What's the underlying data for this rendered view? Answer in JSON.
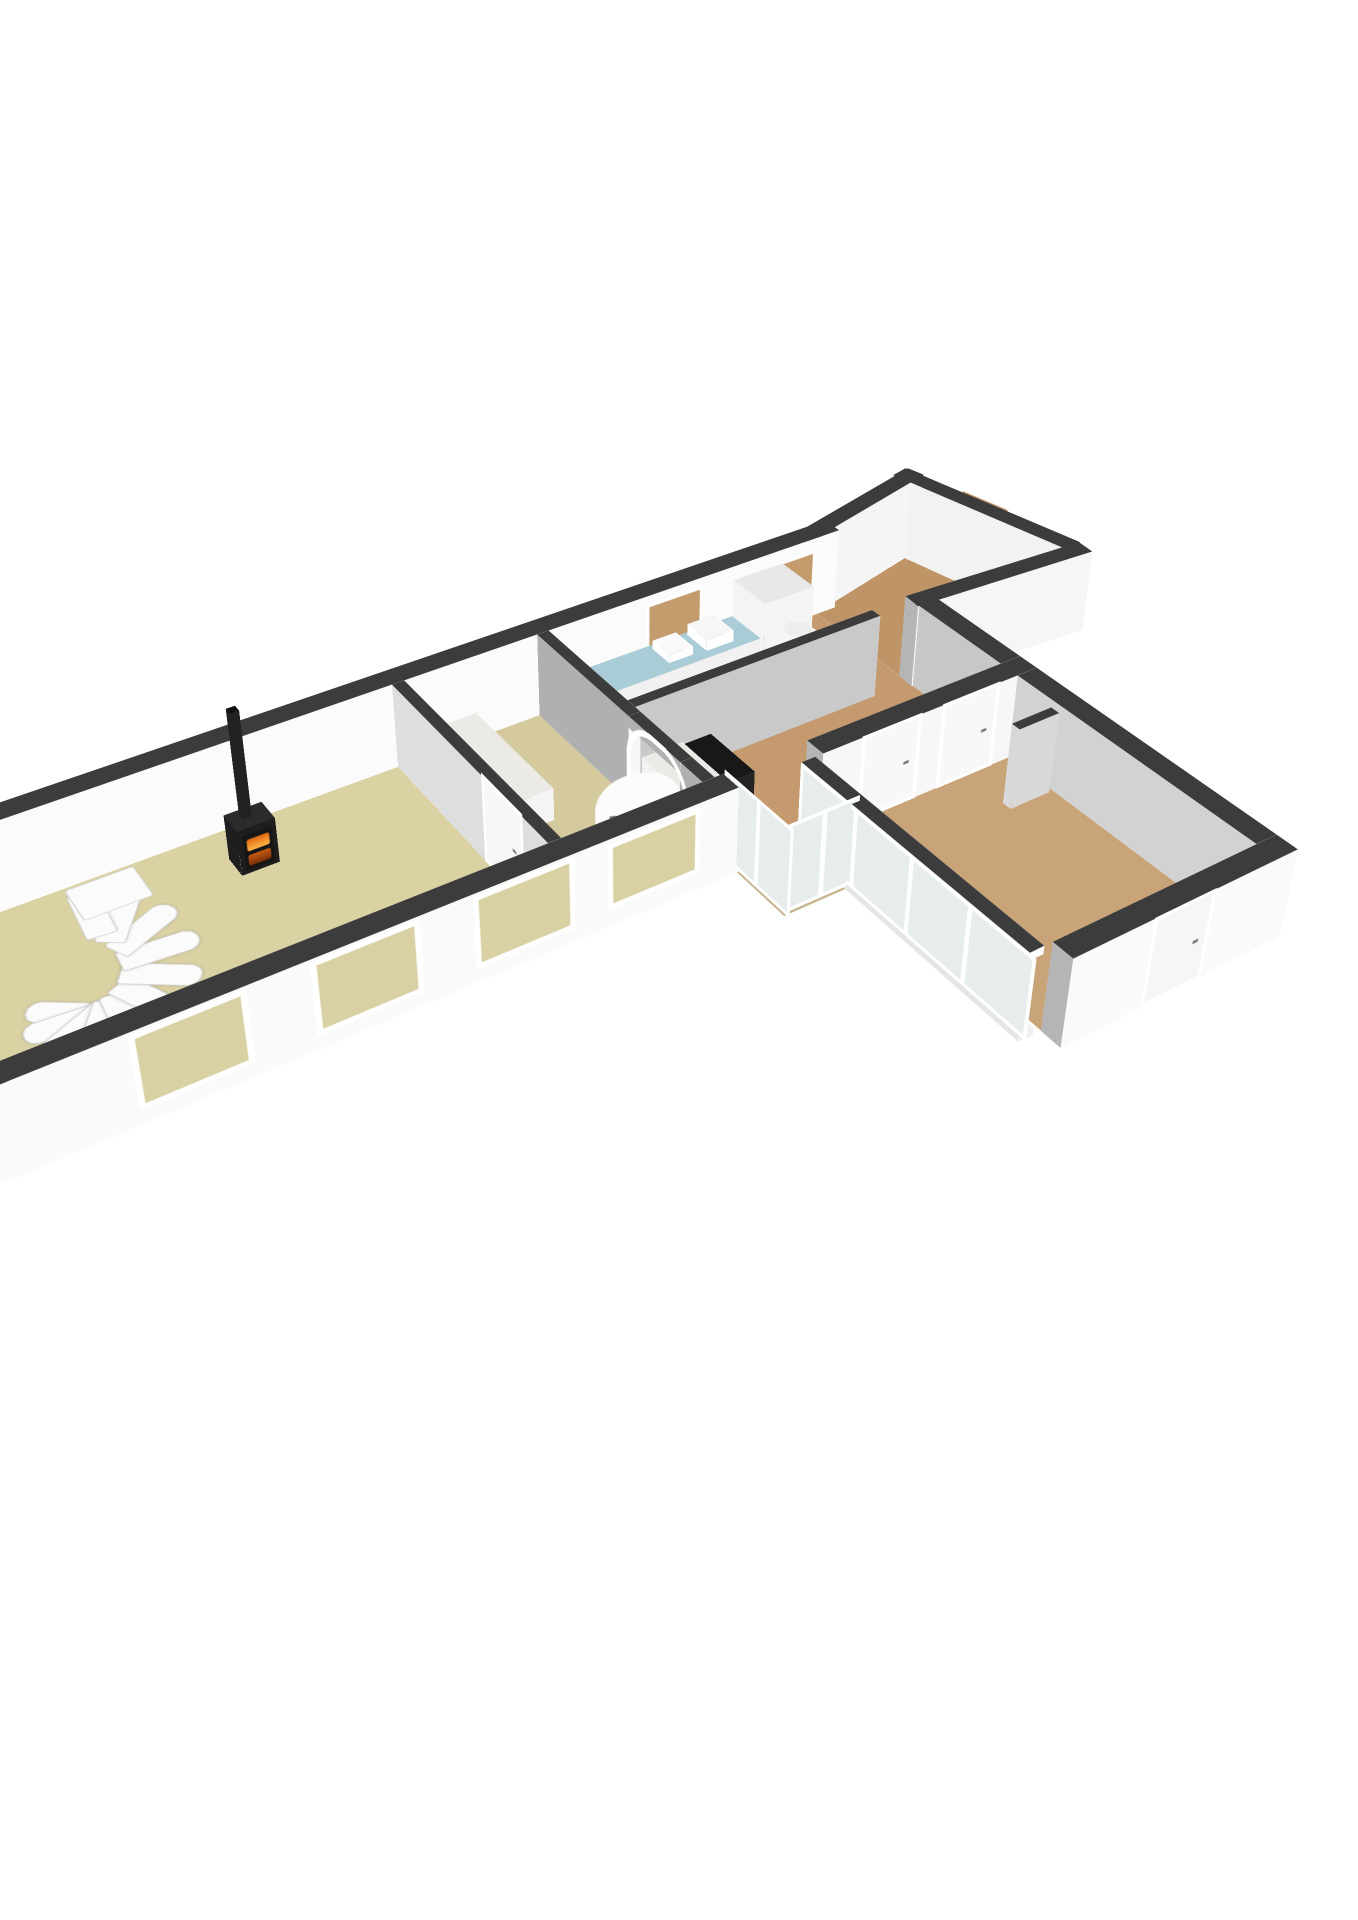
{
  "meta": {
    "view_label": "3d-floorplan-ground-floor",
    "background": "#ffffff"
  },
  "palette": {
    "cap": "#3c3c3c",
    "wallWhite": "#f8f8f8",
    "wallLight": "#eeeeee",
    "wallGray": "#b5b5b5",
    "wallE": "#e9e9e9",
    "floorLiving": "#dbd2a4",
    "floorBath": "#d5c99e",
    "floorWood": "#c49a6e",
    "floorPorch": "#bf9466",
    "floorWing": "#c9a478",
    "floorWC": "#c6b68e",
    "counterBlue": "#a9ccd6",
    "marble": "#eceae6",
    "stoveBlack": "#1e1e1e",
    "fireBright": "#ffb547",
    "fireDeep": "#e06810",
    "glass": "#e7ecec",
    "frameWhite": "#ffffff",
    "doorBrown": "#b58a58",
    "windowBeige": "#d9d0a3",
    "windowTan": "#c39b6d",
    "stairWhite": "#fbfbfb"
  },
  "scene": {
    "wallHeight": 88,
    "camera": {
      "perspective": 1800,
      "perspectiveOrigin": "47% 33%",
      "left": "48%",
      "top": "46%",
      "transform": "scale(1.22) rotateX(57deg) rotateZ(-33deg) translate3d(-540px,-255px,0px)"
    },
    "wallDefaults": {
      "top": "cap",
      "n": "wallLight",
      "s": "wallWhite",
      "e": "wallE",
      "w": "wallGray"
    },
    "floors": [
      {
        "name": "floor-living-room",
        "x": 0,
        "y": 0,
        "w": 440,
        "d": 260,
        "color": "floorLiving"
      },
      {
        "name": "floor-bathroom",
        "x": 452,
        "y": 0,
        "w": 133,
        "d": 260,
        "color": "floorBath"
      },
      {
        "name": "floor-hall-kitchen",
        "x": 597,
        "y": 0,
        "w": 303,
        "d": 260,
        "color": "floorWood"
      },
      {
        "name": "floor-passage",
        "x": 668,
        "y": 260,
        "w": 22,
        "d": 24,
        "color": "floorWood"
      },
      {
        "name": "floor-wc",
        "x": 606,
        "y": 260,
        "w": 62,
        "d": 88,
        "color": "floorWC"
      },
      {
        "name": "floor-wing-room",
        "x": 690,
        "y": 282,
        "w": 210,
        "d": 278,
        "color": "floorWing"
      },
      {
        "name": "floor-porch",
        "x": 900,
        "y": -44,
        "w": 193,
        "d": 190,
        "color": "floorPorch",
        "clip": "polygon(0% 19%, 78% 0%, 100% 97%, 0% 100%)"
      }
    ],
    "walls": [
      {
        "name": "wall-back-exterior",
        "x": -22,
        "y": -22,
        "w": 944,
        "d": 22,
        "colors": {
          "s": "#fbfbfb",
          "n": "#e4e4e4",
          "w": "#dadada",
          "e": "#e2e2e2"
        }
      },
      {
        "name": "wall-left-end",
        "x": -22,
        "y": 0,
        "w": 22,
        "d": 282,
        "colors": {
          "e": "#f3f3f3",
          "w": "#d8d8d8",
          "s": "#efefef",
          "n": "#ececec"
        }
      },
      {
        "name": "wall-front-main",
        "x": -22,
        "y": 260,
        "w": 630,
        "d": 22,
        "colors": {
          "s": "#fafafa",
          "n": "#ebebeb"
        }
      },
      {
        "name": "wall-main-end",
        "x": 900,
        "y": 142,
        "w": 22,
        "d": 118,
        "colors": {
          "w": "#c7c7c7"
        }
      },
      {
        "name": "wall-wing-nw",
        "x": 690,
        "y": 260,
        "w": 232,
        "d": 22,
        "colors": {
          "s": "#f7f7f7",
          "n": "#ebebeb"
        }
      },
      {
        "name": "wall-wing-ne",
        "x": 900,
        "y": 282,
        "w": 22,
        "d": 278,
        "colors": {
          "w": "#d2d2d2",
          "e": "#e8e8e8"
        }
      },
      {
        "name": "wall-wing-se",
        "x": 690,
        "y": 560,
        "w": 232,
        "d": 22,
        "colors": {
          "n": "#f1f1f1",
          "s": "#fafafa"
        }
      },
      {
        "name": "wall-living-divider",
        "x": 440,
        "y": 0,
        "w": 12,
        "d": 260,
        "colors": {
          "w": "#dedede",
          "e": "#f0f0f0"
        }
      },
      {
        "name": "wall-arch-upper",
        "x": 585,
        "y": 0,
        "w": 12,
        "d": 150,
        "colors": {
          "w": "#b0b0b0",
          "e": "#c9c9c9"
        }
      },
      {
        "name": "wall-arch-lower",
        "x": 585,
        "y": 228,
        "w": 12,
        "d": 32,
        "colors": {
          "w": "#b0b0b0",
          "e": "#c9c9c9"
        }
      },
      {
        "name": "wall-arch-lintel",
        "x": 585,
        "y": 150,
        "w": 12,
        "d": 78,
        "z0": 76,
        "h": 12,
        "colors": {
          "w": "#b0b0b0",
          "e": "#c9c9c9"
        }
      },
      {
        "name": "wall-kitchen-mid",
        "x": 597,
        "y": 130,
        "w": 263,
        "d": 12,
        "colors": {
          "s": "#c9c9c9",
          "n": "#d9d9d9"
        }
      },
      {
        "name": "wall-porch-angled",
        "x": 900,
        "y": -22,
        "rot": -14,
        "w": 160,
        "d": 20,
        "colors": {
          "s": "#f5f5f5",
          "n": "#e6e6e6"
        }
      },
      {
        "name": "wall-porch-ne",
        "x": 1053,
        "y": -62,
        "rot": 77,
        "w": 210,
        "d": 20,
        "colors": {
          "n": "#bdbdbd",
          "s": "#f2f2f2"
        }
      },
      {
        "name": "wall-porch-south",
        "x": 900,
        "y": 128,
        "rot": 4,
        "w": 200,
        "d": 20,
        "colors": {
          "n": "#e9e9e9",
          "s": "#f6f6f6"
        }
      },
      {
        "name": "wall-wing-glass-sill",
        "x": 668,
        "y": 282,
        "w": 14,
        "d": 278,
        "h": 7,
        "colors": {
          "top": "#f2f2f2",
          "s": "#efefef",
          "n": "#efefef",
          "e": "#efefef",
          "w": "#e5e5e5"
        }
      },
      {
        "name": "wall-wing-glass-rail",
        "x": 668,
        "y": 282,
        "w": 14,
        "d": 278,
        "z0": 80,
        "h": 8,
        "colors": {
          "s": "#fdfdfd",
          "n": "#fdfdfd",
          "e": "#f4f4f4",
          "w": "#f4f4f4"
        }
      }
    ],
    "boxes": [
      {
        "name": "wood-stove",
        "x": 262,
        "y": 38,
        "w": 34,
        "d": 26,
        "h": 46,
        "top": "#2b2b2b",
        "side": "stoveBlack"
      },
      {
        "name": "stove-chimney",
        "x": 273,
        "y": 44,
        "w": 8,
        "d": 8,
        "z0": 46,
        "h": 106,
        "top": "#111111",
        "side": "#222222"
      },
      {
        "name": "bathtub",
        "x": 456,
        "y": 8,
        "w": 60,
        "d": 132,
        "h": 34,
        "top": "marble",
        "side": "#f4f4f4"
      },
      {
        "name": "shower-tray",
        "x": 460,
        "y": 196,
        "w": 86,
        "d": 56,
        "h": 7,
        "top": "#f4f4f4",
        "side": "#e8e8e8"
      },
      {
        "name": "hall-counter",
        "x": 601,
        "y": 146,
        "w": 42,
        "d": 66,
        "h": 36,
        "top": "marble",
        "side": "#f2f2f2"
      },
      {
        "name": "hall-black-counter",
        "x": 643,
        "y": 146,
        "w": 30,
        "d": 66,
        "h": 33,
        "top": "#181818",
        "side": "#242424"
      },
      {
        "name": "kitchen-counter",
        "x": 612,
        "y": 6,
        "w": 182,
        "d": 46,
        "h": 38,
        "top": "counterBlue",
        "side": "#f1f1f1"
      },
      {
        "name": "kitchen-sink",
        "x": 700,
        "y": 12,
        "w": 26,
        "d": 28,
        "z0": 38,
        "h": 9,
        "top": "#fafafa",
        "side": "#ffffff"
      },
      {
        "name": "kitchen-appliance",
        "x": 740,
        "y": 10,
        "w": 30,
        "d": 32,
        "z0": 38,
        "h": 12,
        "top": "#f6f6f6",
        "side": "#ffffff"
      },
      {
        "name": "fridge-cabinet",
        "x": 796,
        "y": 4,
        "w": 56,
        "d": 50,
        "h": 76,
        "top": "#e8e8e8",
        "side": "#f4f4f4"
      },
      {
        "name": "boiler-cylinder",
        "x": 806,
        "y": 62,
        "w": 26,
        "d": 26,
        "h": 52,
        "round": true,
        "top": "#ededed",
        "side": "#f6f6f6"
      },
      {
        "name": "toilet-bowl",
        "x": 622,
        "y": 300,
        "w": 22,
        "d": 22,
        "h": 24,
        "round": true,
        "top": "#f6f6f6",
        "side": "#fdfdfd"
      },
      {
        "name": "toilet-cistern",
        "x": 642,
        "y": 296,
        "w": 14,
        "d": 26,
        "h": 36,
        "top": "#f2f2f2",
        "side": "#fcfcfc"
      },
      {
        "name": "utility-unit",
        "x": 608,
        "y": 264,
        "w": 26,
        "d": 18,
        "h": 42,
        "top": "#555555",
        "side": "#4a4a4a"
      },
      {
        "name": "wing-closet-door",
        "x": 852,
        "y": 330,
        "w": 44,
        "d": 10,
        "h": 84,
        "top": "#3c3c3c",
        "side": "#d8d8d8"
      }
    ],
    "decals": [
      {
        "name": "window-left-end",
        "axis": "u",
        "x": -22.6,
        "y": 60,
        "z": 14,
        "w": 150,
        "h": 60,
        "frame": 6,
        "fill": "windowBeige",
        "mull": [
          50
        ]
      },
      {
        "name": "window-front-1",
        "axis": "v",
        "x": 85,
        "y": 282.7,
        "z": 14,
        "w": 80,
        "h": 62,
        "frame": 5,
        "fill": "windowBeige"
      },
      {
        "name": "window-front-2",
        "axis": "v",
        "x": 225,
        "y": 282.7,
        "z": 14,
        "w": 80,
        "h": 62,
        "frame": 5,
        "fill": "windowBeige"
      },
      {
        "name": "window-front-3",
        "axis": "v",
        "x": 360,
        "y": 282.7,
        "z": 14,
        "w": 80,
        "h": 62,
        "frame": 5,
        "fill": "windowBeige"
      },
      {
        "name": "window-front-bath",
        "axis": "v",
        "x": 480,
        "y": 282.7,
        "z": 18,
        "w": 78,
        "h": 56,
        "frame": 5,
        "fill": "windowBeige"
      },
      {
        "name": "window-kitchen-back",
        "axis": "v",
        "x": 700,
        "y": 0.7,
        "z": 28,
        "w": 56,
        "h": 44,
        "frame": 4,
        "fill": "windowTan"
      },
      {
        "name": "window-hall-back",
        "axis": "v",
        "x": 843,
        "y": 0.7,
        "z": 28,
        "w": 44,
        "h": 40,
        "frame": 4,
        "fill": "windowTan"
      },
      {
        "name": "door-living-divider",
        "axis": "u",
        "x": 439.3,
        "y": 156,
        "z": 0,
        "w": 58,
        "h": 84,
        "frame": 4,
        "fill": "#f7f7f7",
        "handle": true
      },
      {
        "name": "arch-doorframe",
        "axis": "u",
        "x": 584.3,
        "y": 148,
        "z": 0,
        "w": 82,
        "h": 84,
        "frame": 6,
        "fill": "none",
        "archRadius": 40
      },
      {
        "name": "arch-door-leaf",
        "type": "leaf",
        "x": 589,
        "y": 226,
        "rot": 200,
        "z": 0,
        "w": 74,
        "h": 80,
        "fill": "#fcfcfc",
        "archRadius": 34,
        "handle": true
      },
      {
        "name": "wing-glazing-sw",
        "axis": "u",
        "x": 667.3,
        "y": 282,
        "z": 7,
        "w": 278,
        "h": 73,
        "frame": 4,
        "fill": "glass",
        "mull": [
          25,
          50,
          75
        ]
      },
      {
        "name": "wc-glazing-south",
        "axis": "v",
        "x": 606,
        "y": 348.7,
        "z": 4,
        "w": 62,
        "h": 82,
        "frame": 4,
        "fill": "glass",
        "mull": [
          50
        ]
      },
      {
        "name": "wc-glazing-west",
        "axis": "u",
        "x": 605.3,
        "y": 262,
        "z": 4,
        "w": 86,
        "h": 82,
        "frame": 4,
        "fill": "glass",
        "mull": [
          50
        ]
      },
      {
        "name": "door-wing-1",
        "axis": "v",
        "x": 730,
        "y": 282.7,
        "z": 0,
        "w": 56,
        "h": 82,
        "frame": 4,
        "fill": "#f8f8f8",
        "handle": true
      },
      {
        "name": "door-wing-2",
        "axis": "v",
        "x": 816,
        "y": 282.7,
        "z": 0,
        "w": 56,
        "h": 82,
        "frame": 4,
        "fill": "#f8f8f8",
        "handle": true
      },
      {
        "name": "door-wing-se",
        "axis": "v",
        "x": 770,
        "y": 582.7,
        "z": 0,
        "w": 56,
        "h": 82,
        "frame": 4,
        "fill": "#f6f6f6",
        "handle": true
      },
      {
        "name": "door-porch",
        "type": "rot",
        "x": 1053,
        "y": -62,
        "rot": 77,
        "lx": 66,
        "ly": -0.7,
        "z": 4,
        "w": 54,
        "h": 80,
        "frame": 5,
        "fill": "doorBrown",
        "handle": true
      },
      {
        "name": "stove-fire",
        "type": "fire",
        "axis": "v",
        "x": 266,
        "y": 64.7,
        "z": 4,
        "w": 26,
        "h": 36
      }
    ],
    "stair": {
      "name": "spiral-staircase",
      "cx": 112,
      "cy": 168,
      "steps": 11,
      "startAngle": 215,
      "stepAngle": -30,
      "baseZ": 3,
      "rise": 7.2,
      "stepW": 60,
      "stepD": 22,
      "color": "stairWhite",
      "edge": "#d4d4d4",
      "landing": {
        "x": 108,
        "y": 96,
        "w": 54,
        "d": 40,
        "z": 76
      }
    }
  }
}
